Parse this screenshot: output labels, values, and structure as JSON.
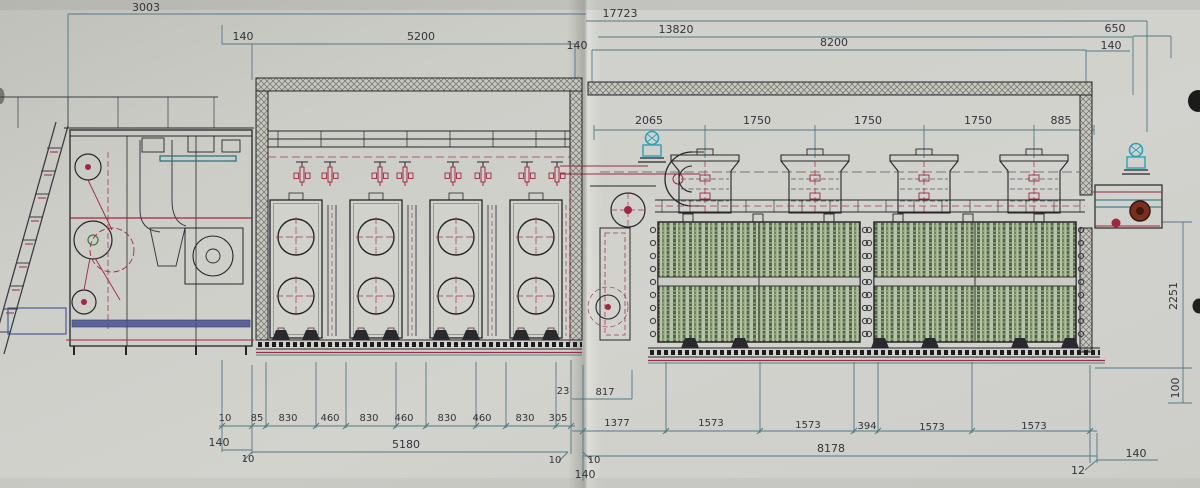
{
  "drawing_title": "dryer-line-elevation",
  "dims": {
    "top": {
      "d3003": "3003",
      "d140L": "140",
      "d5200": "5200",
      "d140M": "140",
      "d17723": "17723",
      "d13820": "13820",
      "d8200": "8200",
      "d650": "650",
      "d140R": "140"
    },
    "mid": {
      "d2065": "2065",
      "d1750a": "1750",
      "d1750b": "1750",
      "d1750c": "1750",
      "d885": "885"
    },
    "right": {
      "d2251": "2251",
      "d100": "100",
      "d140BR": "140",
      "d12": "12"
    },
    "bottomLeft": {
      "cells": [
        "10",
        "85",
        "830",
        "460",
        "830",
        "460",
        "830",
        "460",
        "830",
        "305"
      ],
      "d140": "140",
      "d5180": "5180",
      "d10a": "10"
    },
    "bottomMid": {
      "d23": "23",
      "d817": "817",
      "cells": [
        "1377",
        "1573",
        "1573",
        "394",
        "1573",
        "1573"
      ],
      "d8178": "8178",
      "d10c": "10",
      "d10d": "10",
      "d140F": "140"
    }
  },
  "colors": {
    "dimension_line": "#4d7480",
    "structure": "#26262a",
    "piping_red": "#a02840",
    "motor_cyan": "#2aa3bf",
    "mesh_green": "#4e6b3e",
    "paper": "#cecec9"
  }
}
